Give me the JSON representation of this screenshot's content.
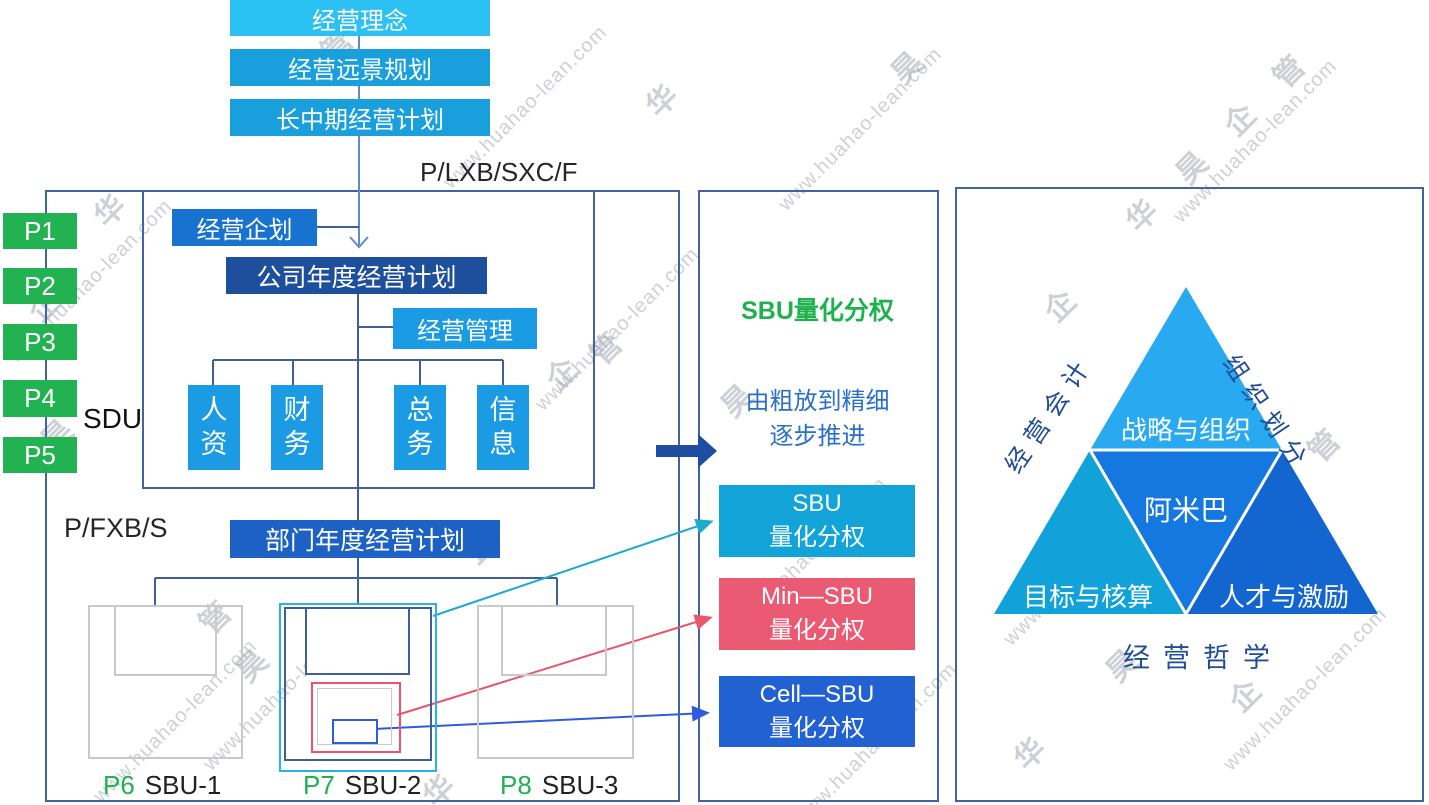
{
  "top_flow": {
    "boxes": [
      "经营理念",
      "经营远景规划",
      "长中期经营计划"
    ],
    "code_label": "P/LXB/SXC/F"
  },
  "left_panel": {
    "p_units": [
      "P1",
      "P2",
      "P3",
      "P4",
      "P5"
    ],
    "sdu_label": "SDU",
    "planning_box": "经营企划",
    "company_plan_box": "公司年度经营计划",
    "management_box": "经营管理",
    "departments": [
      "人资",
      "财务",
      "总务",
      "信息"
    ],
    "dept_code_label": "P/FXB/S",
    "dept_plan_box": "部门年度经营计划",
    "sbus": [
      {
        "code": "P6",
        "name": "SBU-1"
      },
      {
        "code": "P7",
        "name": "SBU-2"
      },
      {
        "code": "P8",
        "name": "SBU-3"
      }
    ]
  },
  "middle_panel": {
    "title": "SBU量化分权",
    "subtitle": [
      "由粗放到精细",
      "逐步推进"
    ],
    "levels": [
      {
        "line1": "SBU",
        "line2": "量化分权"
      },
      {
        "line1": "Min—SBU",
        "line2": "量化分权"
      },
      {
        "line1": "Cell—SBU",
        "line2": "量化分权"
      }
    ]
  },
  "right_panel": {
    "triangle": {
      "top": "战略与组织",
      "center": "阿米巴",
      "bottom_left": "目标与核算",
      "bottom_right": "人才与激励"
    },
    "left_axis": "经营会计",
    "right_axis": "组织划分",
    "bottom_label": "经营哲学"
  },
  "watermark": {
    "url": "www.huahao-lean.com",
    "chars": [
      "华",
      "昊",
      "企",
      "管"
    ]
  },
  "colors": {
    "top_box_first": "#2BC1F2",
    "top_box": "#199FDC",
    "green_unit": "#23B252",
    "planning_blue": "#1773CF",
    "company_navy": "#1E4F9C",
    "cyan_box": "#1B9BE3",
    "dept_plan_blue": "#1D61C5",
    "level_sbu": "#12A3D8",
    "level_min": "#EA5A72",
    "level_cell": "#2161D2",
    "triangle_top": "#29AAF0",
    "triangle_center": "#1577E0",
    "triangle_bottom_left": "#10A2D8",
    "triangle_bottom_right": "#1365CF",
    "panel_border": "#41639E",
    "connector": "#3E6092",
    "flow_arrow": "#5B8BD0",
    "thick_arrow": "#1F4EA0",
    "teal_arrow": "#1CAACD",
    "red_arrow": "#E8556D",
    "blue_arrow": "#2F5BE0",
    "green_text": "#21B14E"
  }
}
